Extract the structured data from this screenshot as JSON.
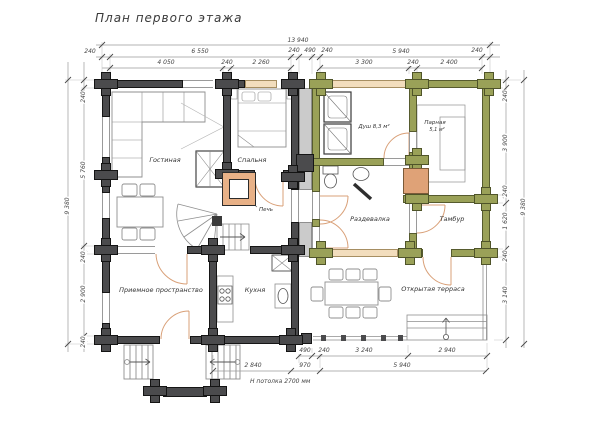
{
  "title": "План первого этажа",
  "rooms": {
    "living": "Гостиная",
    "bedroom": "Спальня",
    "stove": "Печь",
    "shower": "Душ 8,3 м²",
    "steam": "Парная",
    "steam_area": "5,1 м²",
    "dressing": "Раздевалка",
    "vestibule": "Тамбур",
    "reception": "Приемное пространство",
    "kitchen": "Кухня",
    "terrace": "Открытая терраса"
  },
  "dimensions": {
    "top_overall": "13 940",
    "top_row2": [
      "240",
      "6 550",
      "240",
      "490",
      "240",
      "5 940",
      "240"
    ],
    "top_row3": [
      "4 050",
      "240",
      "2 260",
      "3 300",
      "240",
      "2 400"
    ],
    "left_overall": "9 380",
    "left_segments": [
      "240",
      "5 760",
      "240",
      "2 900",
      "240"
    ],
    "right_overall": "9 380",
    "right_segments": [
      "240",
      "3 900",
      "240",
      "1 620",
      "240",
      "3 140"
    ],
    "bottom_row1": [
      "490",
      "240",
      "3 240",
      "2 940"
    ],
    "bottom_row2": [
      "2 840",
      "970",
      "5 940"
    ],
    "ceiling_note": "Н потолка 2700 мм"
  },
  "colors": {
    "wall_dark": "#4b4b4d",
    "wall_olive": "#9aa158",
    "beam_tan": "#f2ddbd",
    "buffer_gray": "#cbcbcb",
    "stove_orange": "#e8b187",
    "door_arc": "#d9a078"
  }
}
